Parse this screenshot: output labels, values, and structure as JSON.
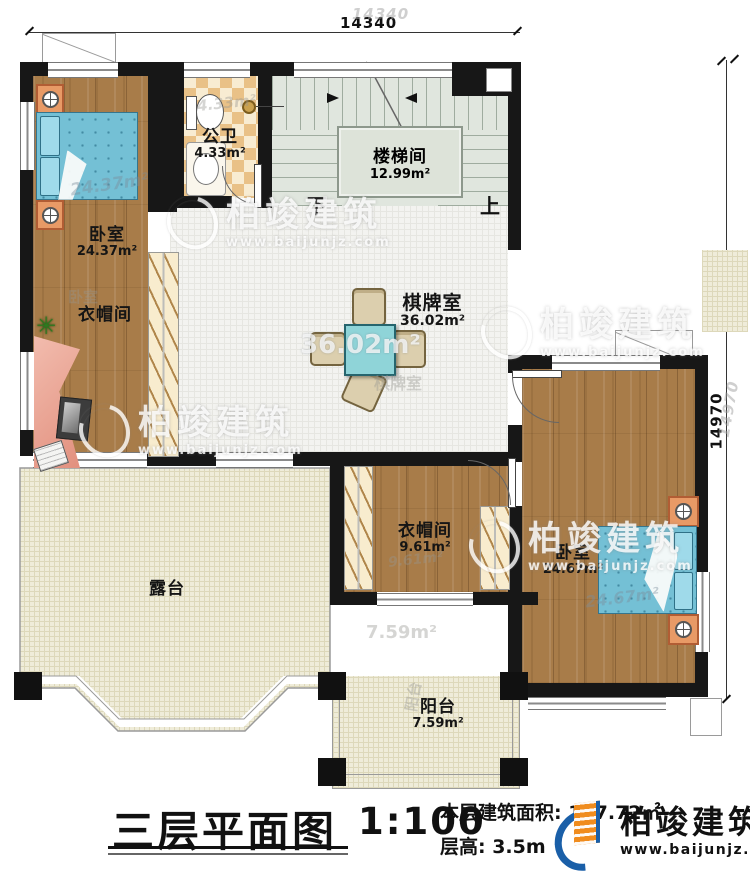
{
  "dimensions": {
    "top": "14340",
    "right": "14970"
  },
  "rooms": {
    "bedroom_left": {
      "name": "卧室",
      "area": "24.37m²"
    },
    "bathroom": {
      "name": "公卫",
      "area": "4.33m²"
    },
    "stairwell": {
      "name": "楼梯间",
      "area": "12.99m²"
    },
    "game_room": {
      "name": "棋牌室",
      "area": "36.02m²"
    },
    "cloakroom_left": {
      "name": "衣帽间"
    },
    "cloakroom_right": {
      "name": "衣帽间",
      "area": "9.61m²"
    },
    "bedroom_right": {
      "name": "卧室",
      "area": "24.67m²"
    },
    "terrace": {
      "name": "露台"
    },
    "balcony": {
      "name": "阳台",
      "area": "7.59m²"
    }
  },
  "stairs": {
    "down": "下",
    "up": "上"
  },
  "ghosts": {
    "bedroom_left_area": "24.37m²",
    "bathroom_area": "4.33m²",
    "game_area": "36.02m²",
    "game_name": "棋牌室",
    "bedroom_label": "卧室",
    "bedroom_right_area": "24.67m²",
    "cloakroom_right_area": "9.61m²",
    "terrace_area": "7.59m²",
    "balcony_name": "阳台",
    "dim_right": "14970"
  },
  "watermark": {
    "name": "柏竣建筑",
    "url": "www.baijunjz.com"
  },
  "title_block": {
    "title": "三层平面图",
    "scale": "1:100",
    "area_label": "本层建筑面积: 137.72㎡",
    "floor_height": "层高: 3.5m"
  },
  "logo": {
    "name": "柏竣建筑",
    "url": "www.baijunjz.com"
  }
}
